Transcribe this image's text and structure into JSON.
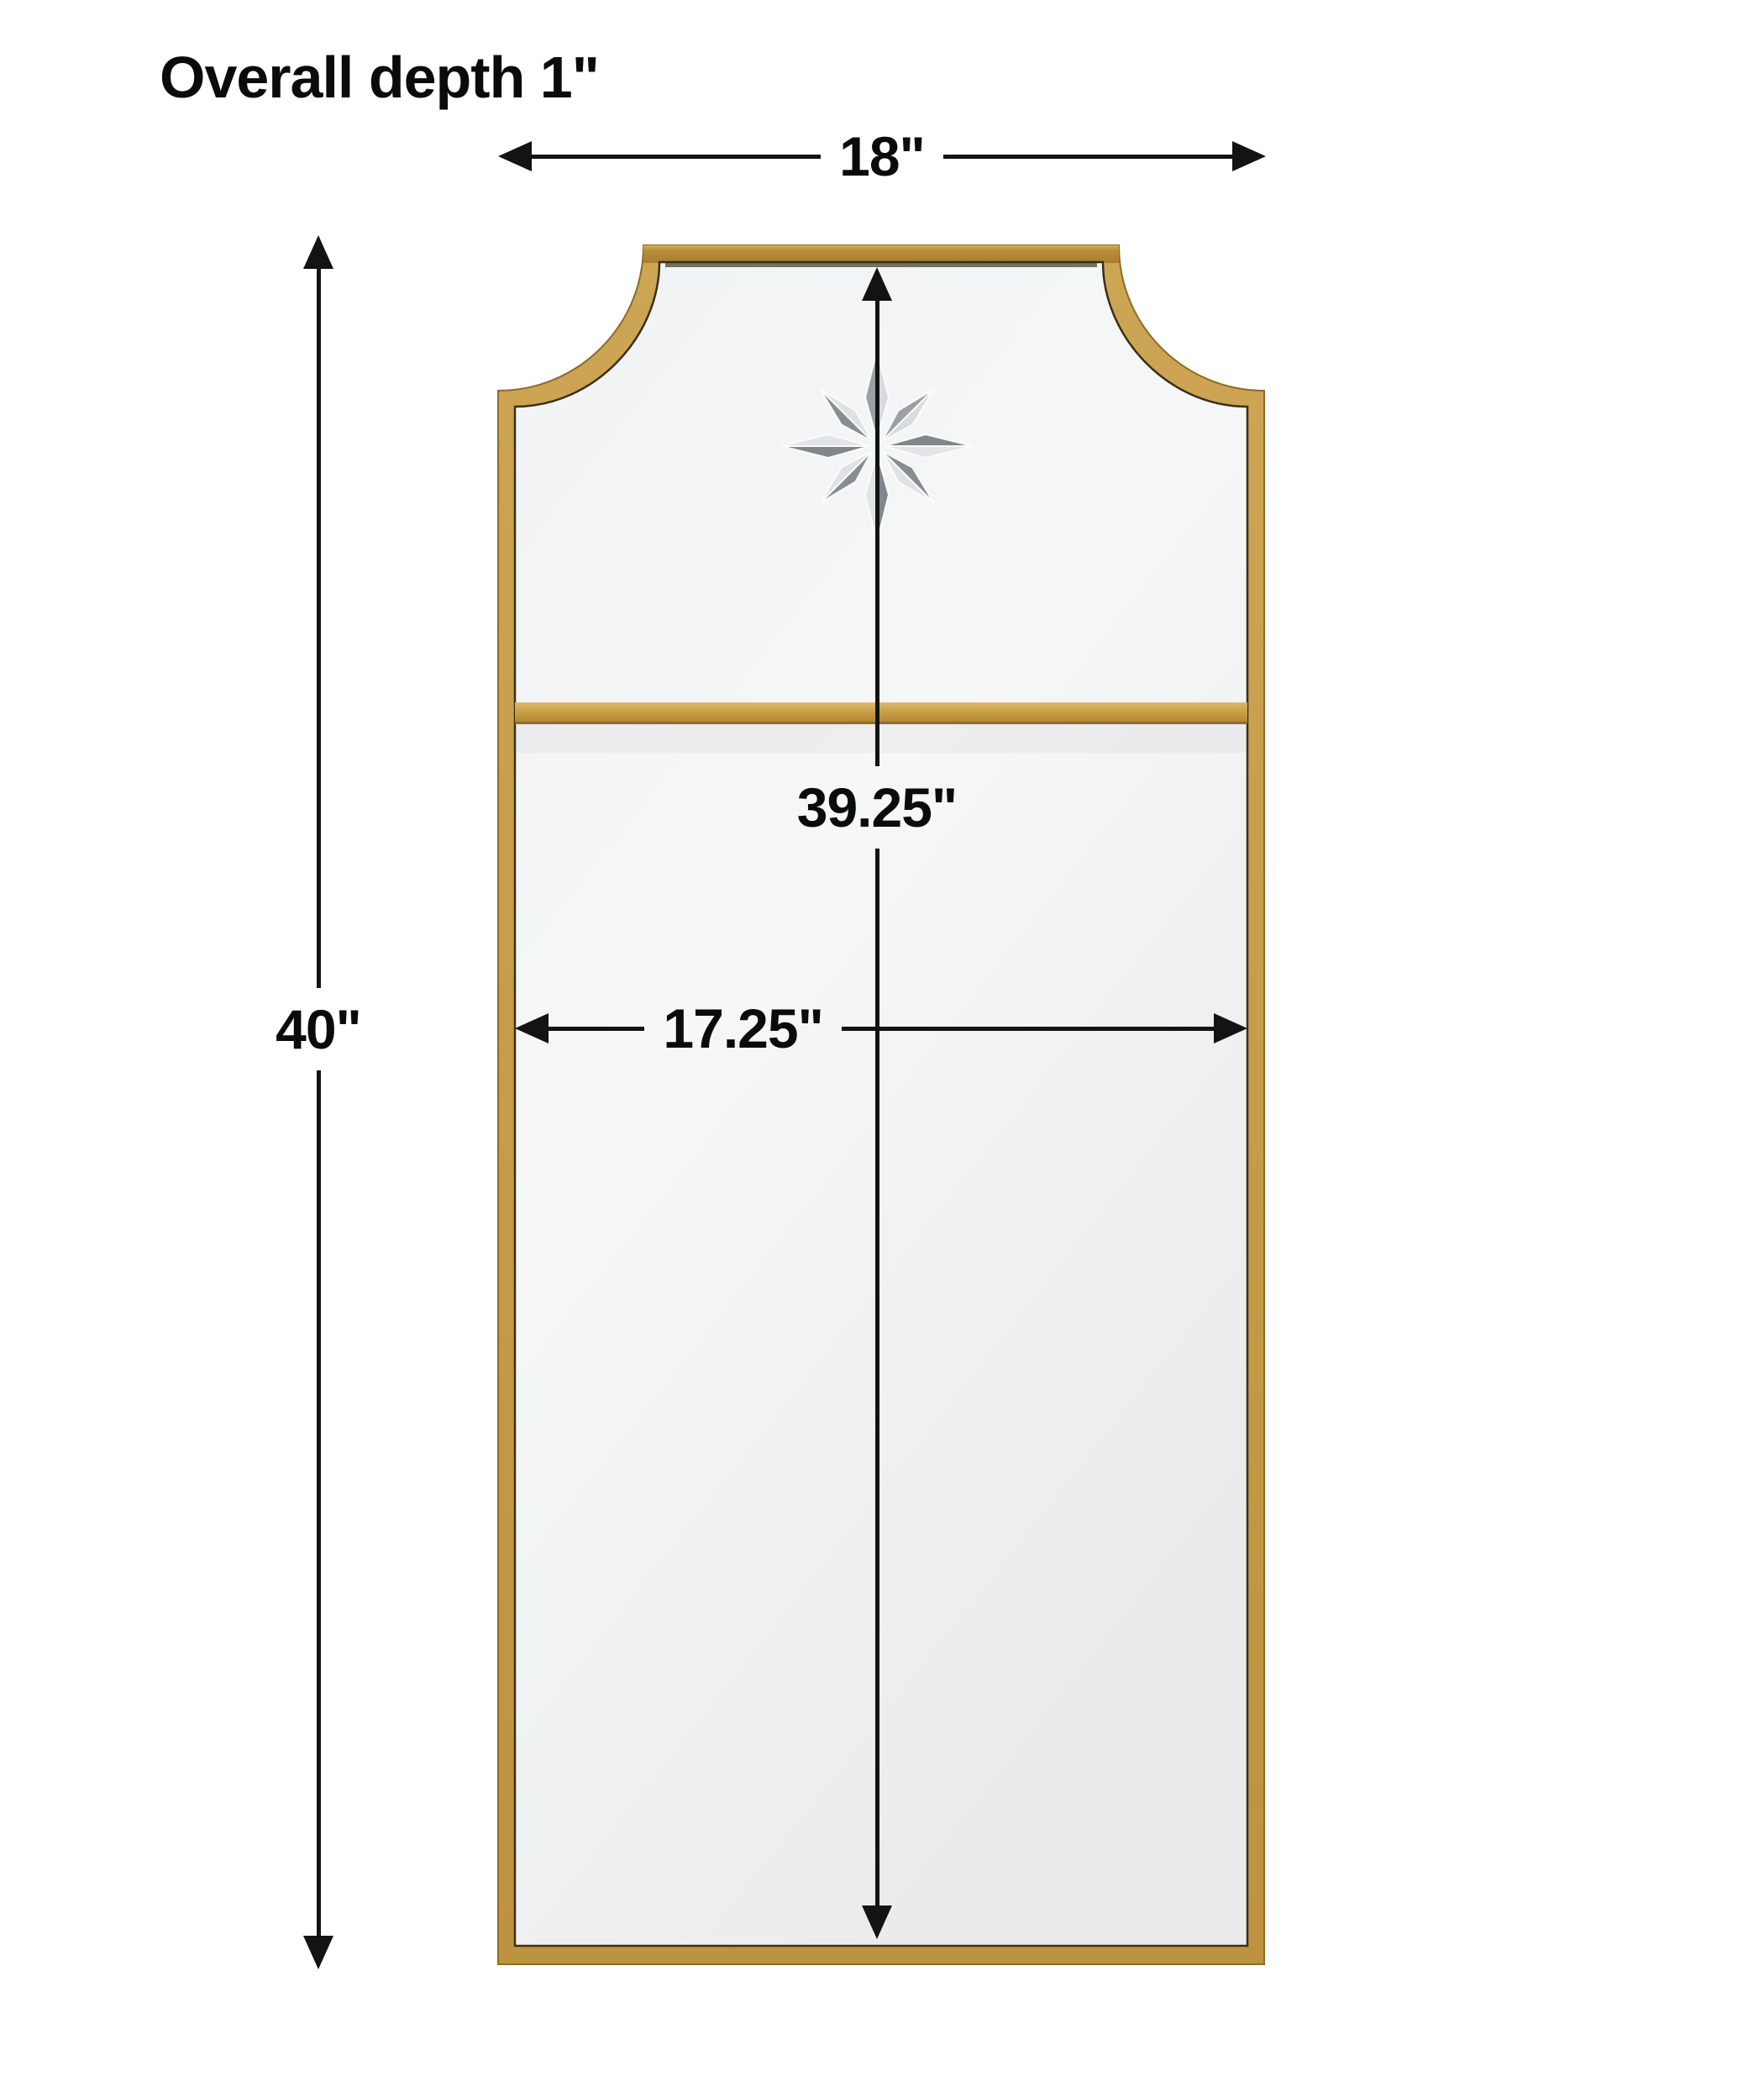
{
  "title": "Overall depth 1\"",
  "dimensions": {
    "overall_depth": {
      "label": "Overall depth 1\"",
      "value_inches": 1
    },
    "overall_width": {
      "label": "18\"",
      "value_inches": 18
    },
    "overall_height": {
      "label": "40\"",
      "value_inches": 40
    },
    "inner_height": {
      "label": "39.25\"",
      "value_inches": 39.25
    },
    "inner_width": {
      "label": "17.25\"",
      "value_inches": 17.25
    }
  },
  "mirror": {
    "parts": [
      "gold-frame",
      "scooped-top-corners",
      "top-glass-panel",
      "bottom-glass-panel",
      "gold-divider-bar",
      "etched-star"
    ],
    "star_points": 8
  },
  "colors": {
    "background": "#FFFFFF",
    "line": "#131313",
    "text": "#0B0B0B",
    "gold-main": "#C49C4C",
    "gold-light": "#DDBA6C",
    "gold-dark": "#A87F31",
    "gold-edge": "#8F6A28",
    "frame-inner-shadow": "#3A2F17",
    "glass-light": "#F6F7F7",
    "glass-dark": "#E9EBEC",
    "star-light": "#E2E5E7",
    "star-dark": "#80868A"
  }
}
